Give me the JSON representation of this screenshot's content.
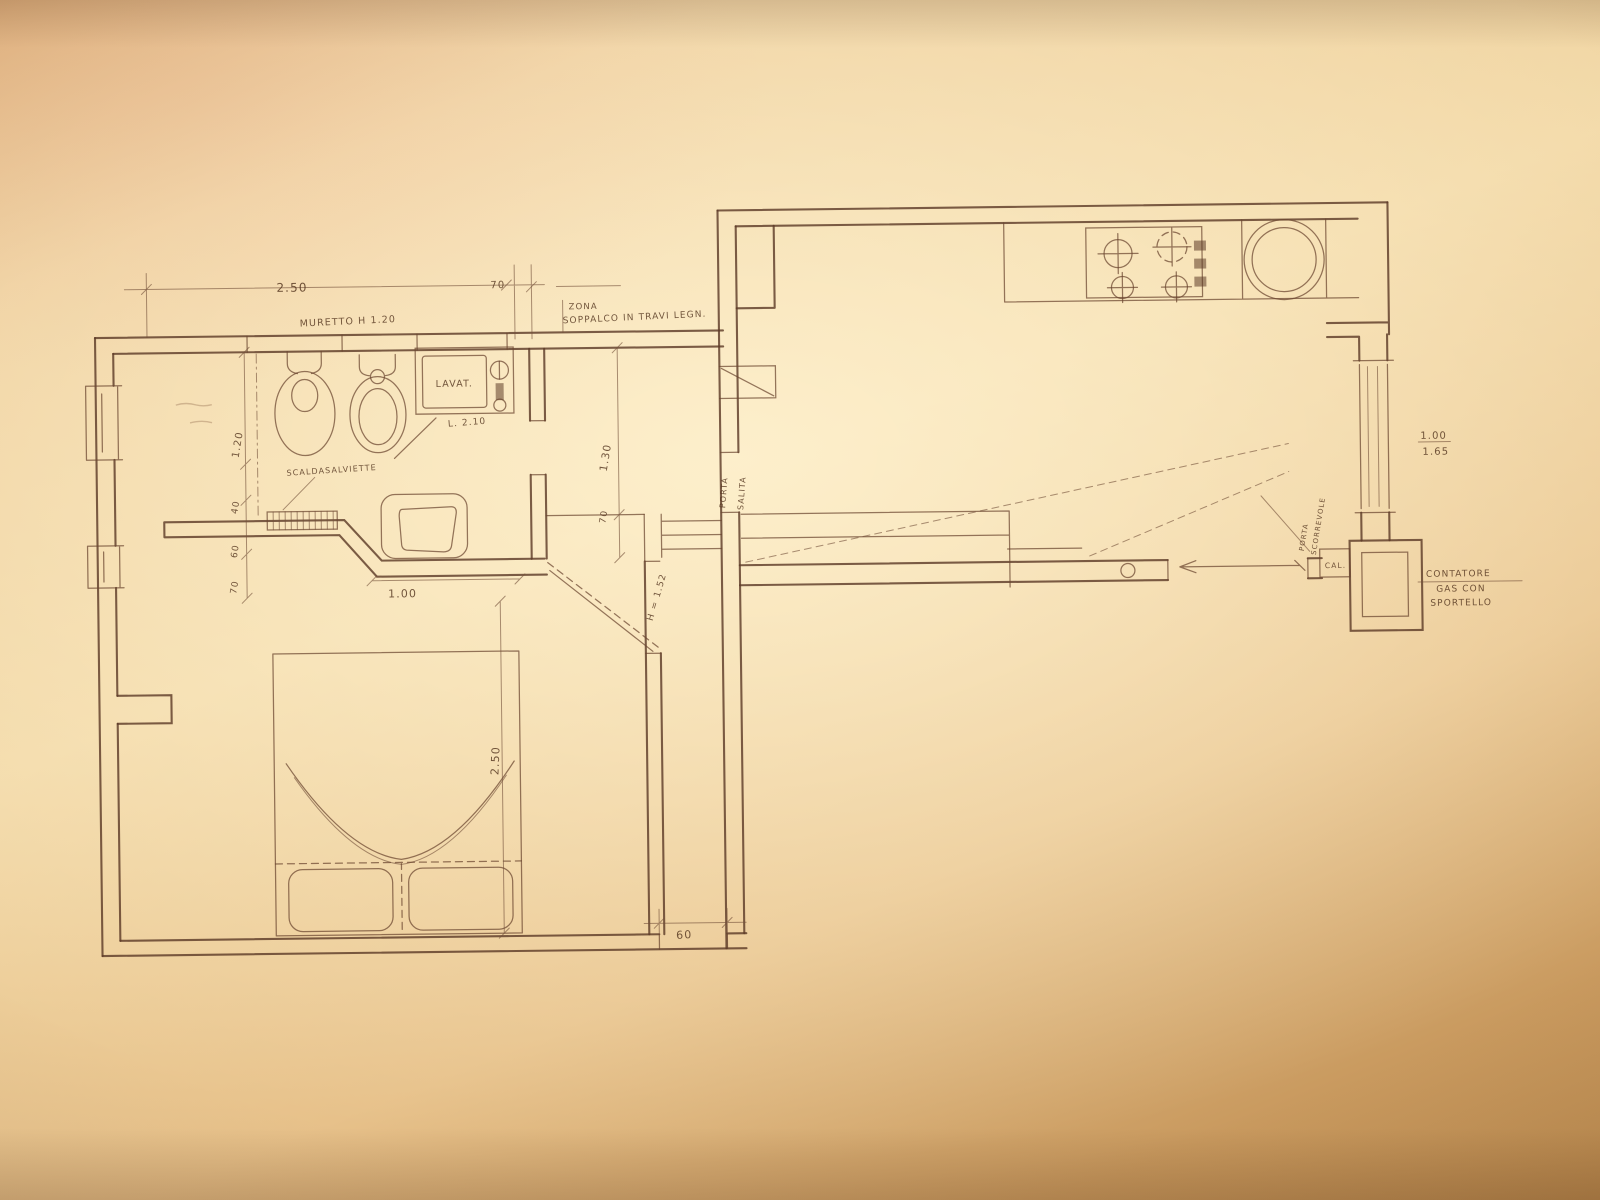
{
  "plan": {
    "labels": {
      "muretto": "MURETTO H 1.20",
      "zona": "ZONA",
      "soppalco": "SOPPALCO IN TRAVI LEGN.",
      "lavatrice": "LAVAT.",
      "lavatrice_l": "L. 2.10",
      "scaldasalviette": "SCALDASALVIETTE",
      "porta": "PORTA",
      "salita": "SALITA",
      "altezza": "H = 1.52",
      "cal": "CAL.",
      "porta_scorrevole_a": "PORTA",
      "porta_scorrevole_b": "SCORREVOLE",
      "contatore_a": "CONTATORE",
      "contatore_b": "GAS CON",
      "contatore_c": "SPORTELLO"
    },
    "dims": {
      "top_width": "2.50",
      "top_pier": "70",
      "left_a": "1.20",
      "left_b": "40",
      "left_c": "60",
      "left_d": "70",
      "bath_len": "1.30",
      "bath_door": "70",
      "bath_width": "1.00",
      "bed_width": "2.50",
      "passage": "60",
      "win_w": "1.00",
      "win_h": "1.65"
    }
  }
}
